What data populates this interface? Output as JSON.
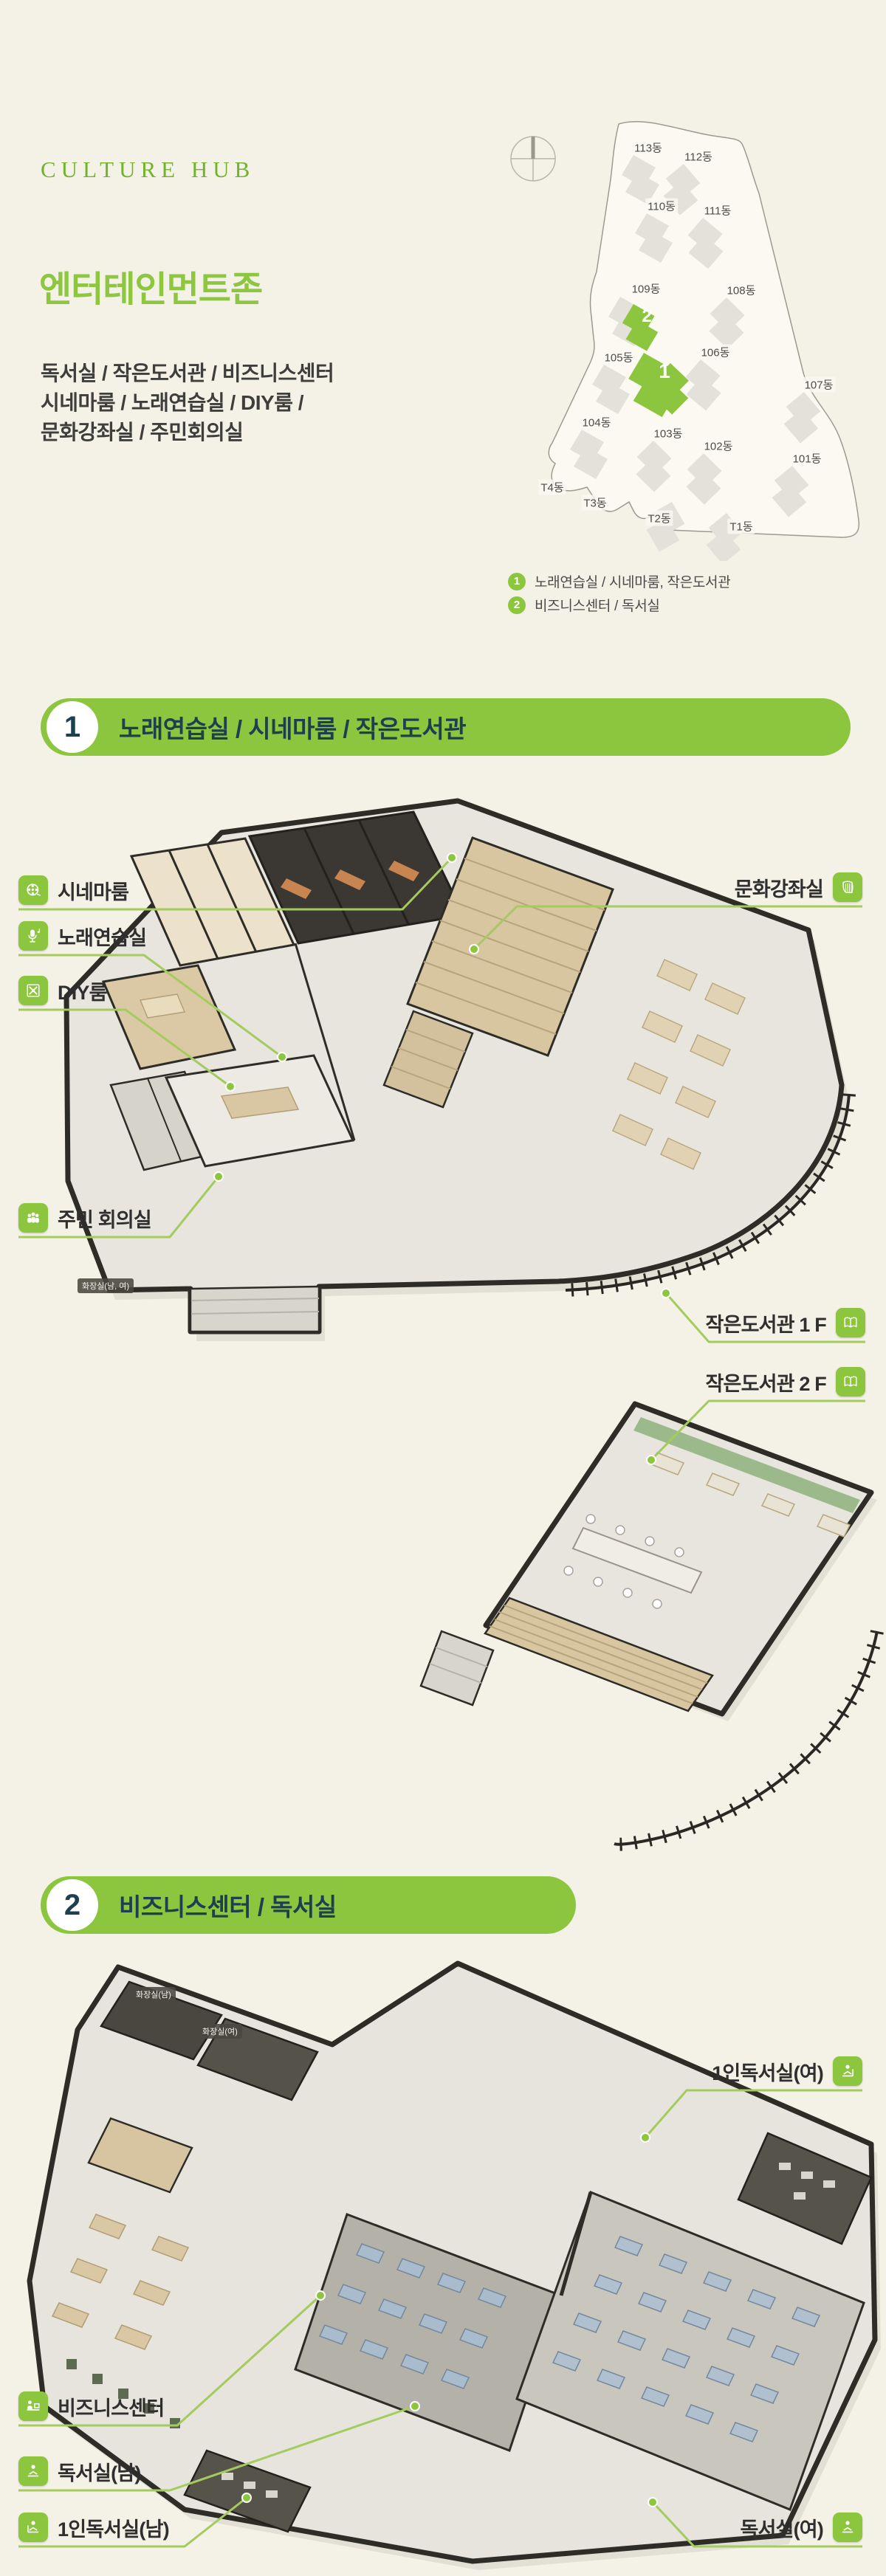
{
  "header": {
    "brand": "CULTURE HUB",
    "title": "엔터테인먼트존",
    "desc1": "독서실 / 작은도서관 / 비즈니스센터",
    "desc2": "시네마룸 / 노래연습실 / DIY룸 /",
    "desc3": "문화강좌실 / 주민회의실"
  },
  "site_map": {
    "buildings": [
      {
        "label": "113동"
      },
      {
        "label": "112동"
      },
      {
        "label": "110동"
      },
      {
        "label": "111동"
      },
      {
        "label": "109동"
      },
      {
        "label": "108동"
      },
      {
        "label": "105동"
      },
      {
        "label": "106동"
      },
      {
        "label": "107동"
      },
      {
        "label": "104동"
      },
      {
        "label": "103동"
      },
      {
        "label": "102동"
      },
      {
        "label": "101동"
      },
      {
        "label": "T4동"
      },
      {
        "label": "T3동"
      },
      {
        "label": "T2동"
      },
      {
        "label": "T1동"
      }
    ],
    "markers": [
      {
        "number": "1"
      },
      {
        "number": "2"
      }
    ],
    "legend": [
      {
        "number": "1",
        "text": "노래연습실 / 시네마룸, 작은도서관"
      },
      {
        "number": "2",
        "text": "비즈니스센터 / 독서실"
      }
    ]
  },
  "section1": {
    "number": "1",
    "title": "노래연습실 / 시네마룸 / 작은도서관"
  },
  "section2": {
    "number": "2",
    "title": "비즈니스센터 / 독서실"
  },
  "plan1": {
    "cinema": "시네마룸",
    "karaoke": "노래연습실",
    "diy": "DIY룸",
    "meeting": "주민 회의실",
    "culture": "문화강좌실",
    "library1f": "작은도서관 1 F",
    "library2f": "작은도서관 2 F",
    "restroom": "화장실(남, 여)"
  },
  "plan2": {
    "restroom_m": "화장실(남)",
    "restroom_f": "화장실(여)",
    "single_f": "1인독서실(여)",
    "business": "비즈니스센터",
    "reading_m": "독서실(남)",
    "single_m": "1인독서실(남)",
    "reading_f": "독서실(여)"
  },
  "colors": {
    "background": "#f4f1e6",
    "accent_green": "#8cc63e",
    "leader_green": "#a4cb5e",
    "banner_text": "#1d4050",
    "brand_green": "#72b32c"
  }
}
